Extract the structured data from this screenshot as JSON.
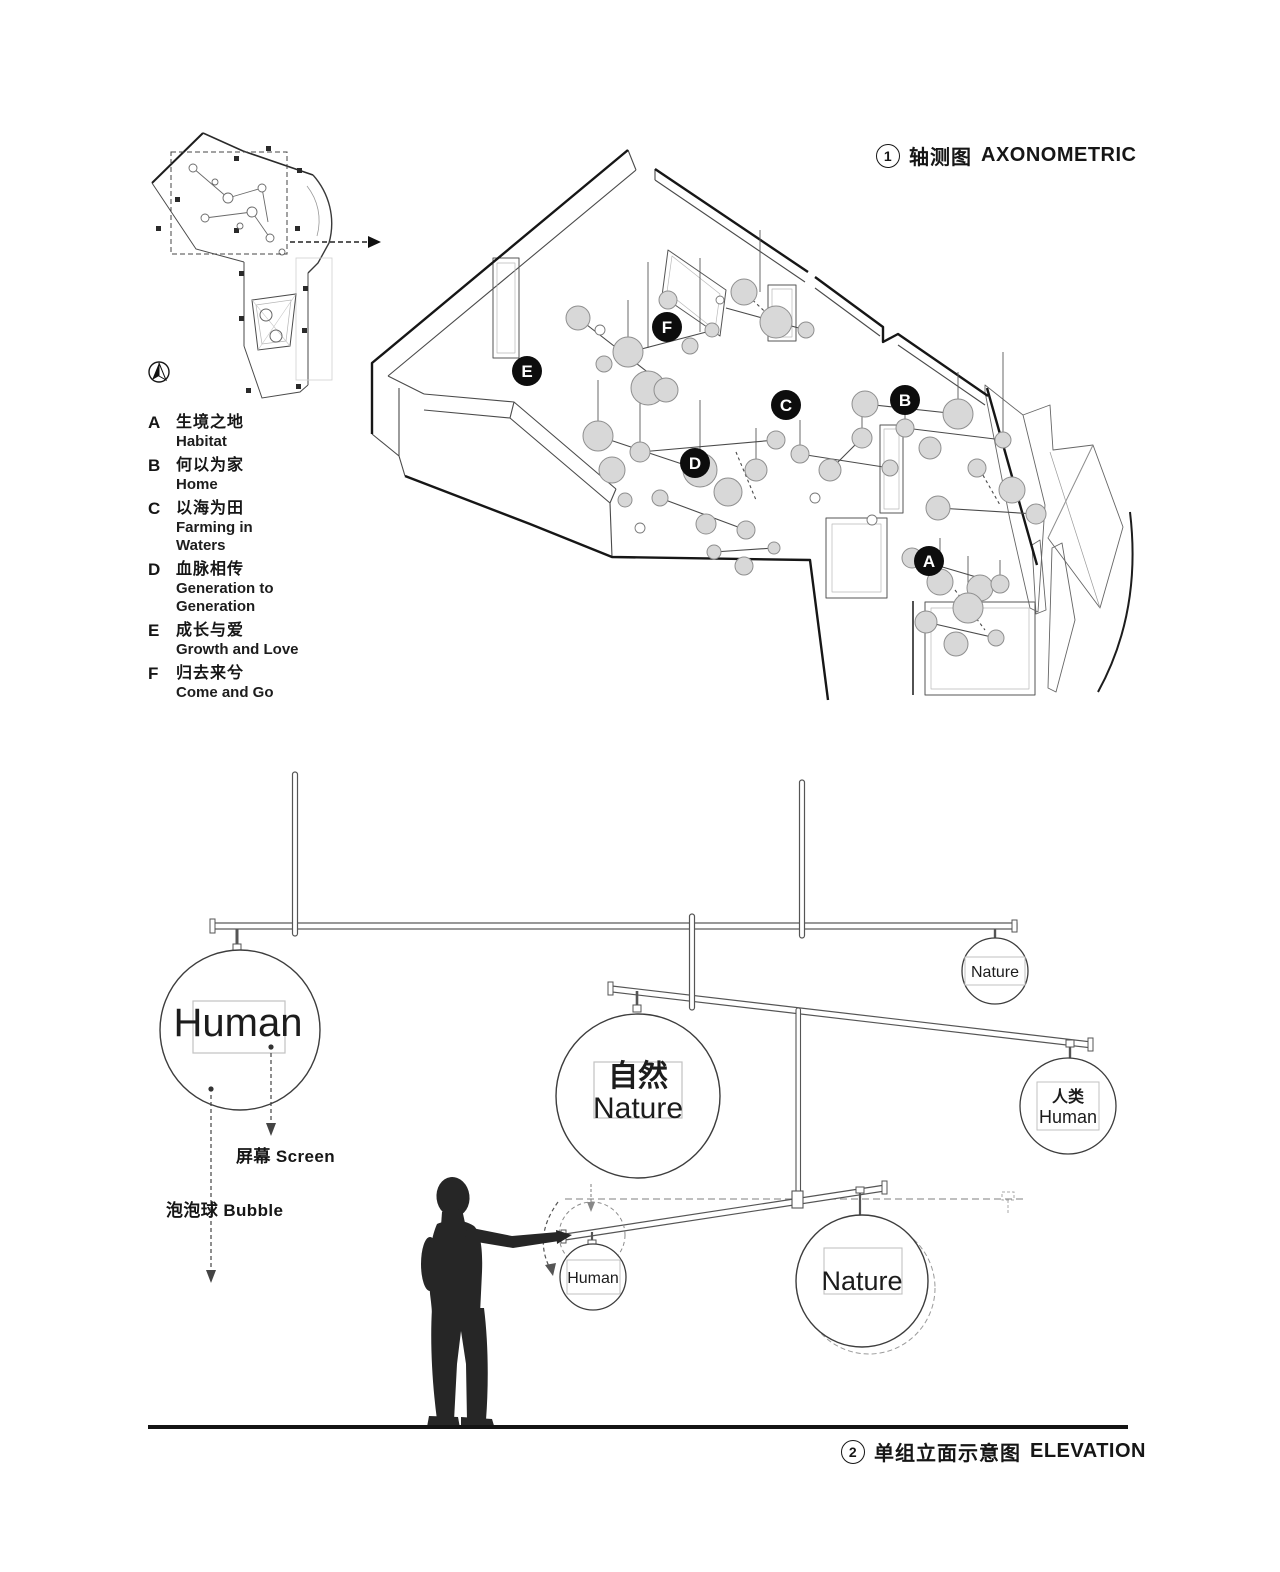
{
  "axonometric": {
    "number": "1",
    "title_zh": "轴测图",
    "title_en": "AXONOMETRIC",
    "badges": [
      "A",
      "B",
      "C",
      "D",
      "E",
      "F"
    ]
  },
  "legend": {
    "items": [
      {
        "letter": "A",
        "zh": "生境之地",
        "en": "Habitat"
      },
      {
        "letter": "B",
        "zh": "何以为家",
        "en": "Home"
      },
      {
        "letter": "C",
        "zh": "以海为田",
        "en": "Farming in\nWaters"
      },
      {
        "letter": "D",
        "zh": "血脉相传",
        "en": "Generation to\nGeneration"
      },
      {
        "letter": "E",
        "zh": "成长与爱",
        "en": "Growth and Love"
      },
      {
        "letter": "F",
        "zh": "归去来兮",
        "en": "Come and Go"
      }
    ]
  },
  "elevation": {
    "number": "2",
    "title_zh": "单组立面示意图",
    "title_en": "ELEVATION",
    "balls": {
      "human_large": "Human",
      "nature_center_zh": "自然",
      "nature_center_en": "Nature",
      "nature_top_right": "Nature",
      "human_right_zh": "人类",
      "human_right_en": "Human",
      "human_small": "Human",
      "nature_bottom": "Nature"
    },
    "callouts": {
      "screen": "屏幕 Screen",
      "bubble": "泡泡球 Bubble"
    }
  }
}
